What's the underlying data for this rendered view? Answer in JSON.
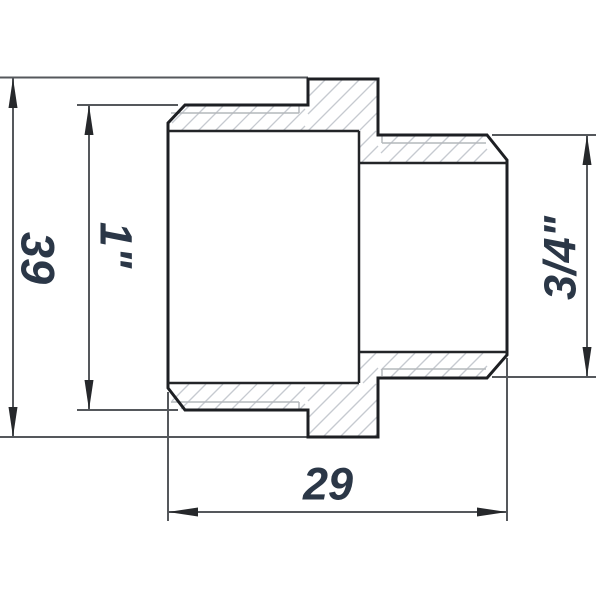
{
  "drawing": {
    "type": "technical-section-drawing",
    "part": "reducing-nipple-fitting",
    "dimensions": {
      "overall_height": {
        "label": "39"
      },
      "thread_left": {
        "label": "1\""
      },
      "thread_right": {
        "label": "3/4\""
      },
      "overall_length": {
        "label": "29"
      }
    },
    "colors": {
      "text": "#2b3747",
      "outline": "#1d1f23",
      "dimension_line": "#55585c",
      "thin_line": "#b4b8bc",
      "hatch": "#c6cad0",
      "background": "#ffffff"
    }
  }
}
